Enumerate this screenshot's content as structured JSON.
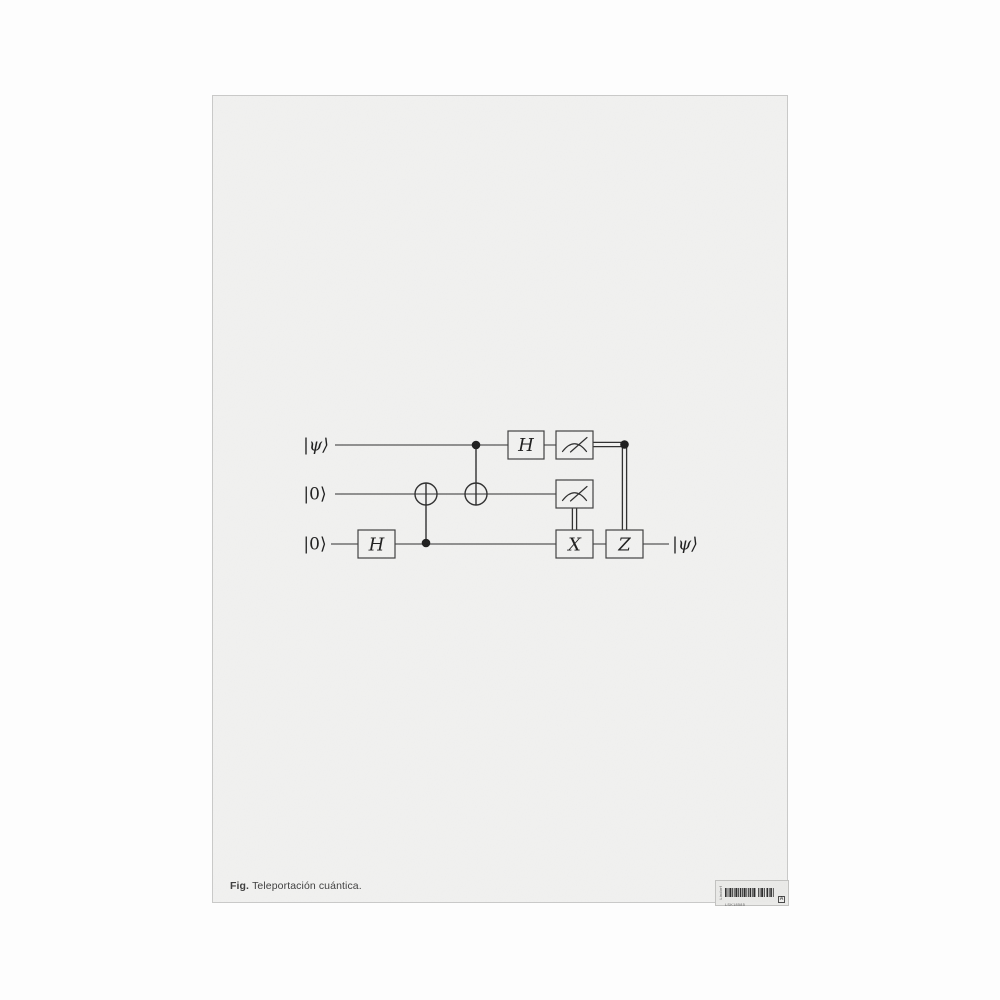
{
  "caption": {
    "prefix": "Fig.",
    "text": "Teleportación cuántica."
  },
  "sticker": {
    "side_text": "Lindorf",
    "code": "LSK18585",
    "grade": "A"
  },
  "circuit": {
    "qubits": [
      {
        "input_label": "|ψ⟩"
      },
      {
        "input_label": "|0⟩"
      },
      {
        "input_label": "|0⟩",
        "output_label": "|ψ⟩"
      }
    ],
    "gates": {
      "hadamard_q0": "H",
      "hadamard_q2": "H",
      "x_correction": "X",
      "z_correction": "Z"
    },
    "description": "Quantum teleportation circuit: H on bottom qubit, CNOT bottom→middle, CNOT top→middle, H on top qubit, measurement of top and middle qubits, classically controlled X (from middle measurement) and Z (from top measurement) corrections on bottom qubit, output |ψ⟩."
  },
  "colors": {
    "page_background": "#f1f1f0",
    "outer_background": "#fdfdfd",
    "ink": "#2e2e2e",
    "quantum_wire": "#6e6e6e",
    "caption_text": "#3d3d3d"
  }
}
